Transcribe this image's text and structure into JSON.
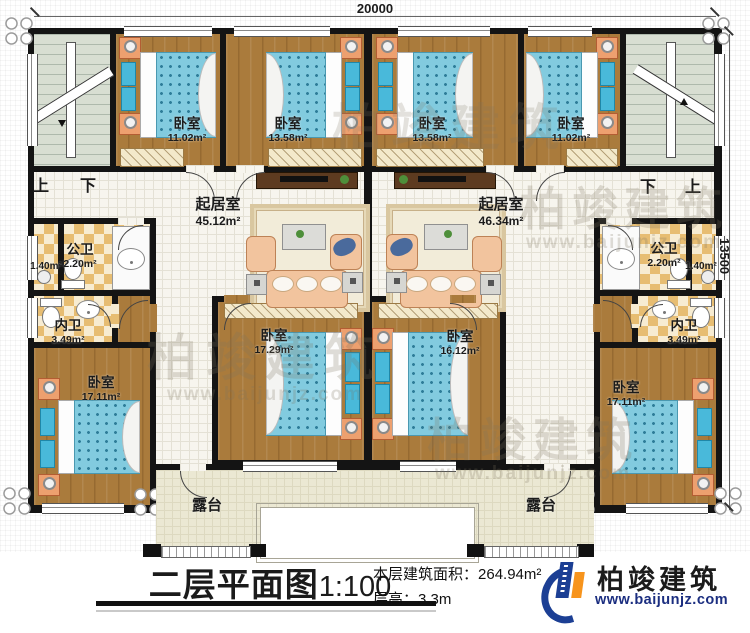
{
  "plan": {
    "dim_top": "20000",
    "dim_right": "13500",
    "stairs_left": {
      "up": "上",
      "down": "下"
    },
    "stairs_right": {
      "up": "上",
      "down": "下"
    },
    "rooms": {
      "br_a1": {
        "name": "卧室",
        "area": "11.02m²"
      },
      "br_a2": {
        "name": "卧室",
        "area": "13.58m²"
      },
      "br_b1": {
        "name": "卧室",
        "area": "13.58m²"
      },
      "br_b2": {
        "name": "卧室",
        "area": "11.02m²"
      },
      "lr_left": {
        "name": "起居室",
        "area": "45.12m²"
      },
      "lr_right": {
        "name": "起居室",
        "area": "46.34m²"
      },
      "pw_left": {
        "name": "公卫",
        "area": "2.20m²"
      },
      "pw_right": {
        "name": "公卫",
        "area": "2.20m²"
      },
      "sh_left": {
        "area": "1.40m²"
      },
      "sh_right": {
        "area": "1.40m²"
      },
      "nw_left": {
        "name": "内卫",
        "area": "3.49m²"
      },
      "nw_right": {
        "name": "内卫",
        "area": "3.49m²"
      },
      "br_d1": {
        "name": "卧室",
        "area": "17.29m²"
      },
      "br_d2": {
        "name": "卧室",
        "area": "16.12m²"
      },
      "br_c1": {
        "name": "卧室",
        "area": "17.11m²"
      },
      "br_c2": {
        "name": "卧室",
        "area": "17.11m²"
      },
      "terrace_left": {
        "name": "露台"
      },
      "terrace_right": {
        "name": "露台"
      }
    }
  },
  "footer": {
    "title": "二层平面图",
    "scale": "1:100",
    "area_label": "本层建筑面积：",
    "area_value": "264.94m²",
    "floor_height_label": "层高：",
    "floor_height_value": "3.3m"
  },
  "brand": {
    "name": "柏竣建筑",
    "url": "www.baijunjz.com"
  },
  "watermark": {
    "name": "柏竣建筑",
    "url": "www.baijunjz.com"
  },
  "colors": {
    "wall": "#141414",
    "wood": "#aa7b3c",
    "mattress": "#82cbdf",
    "sofa": "#f2c49e",
    "logo_navy": "#1c3f94",
    "logo_orange": "#f7941d"
  }
}
